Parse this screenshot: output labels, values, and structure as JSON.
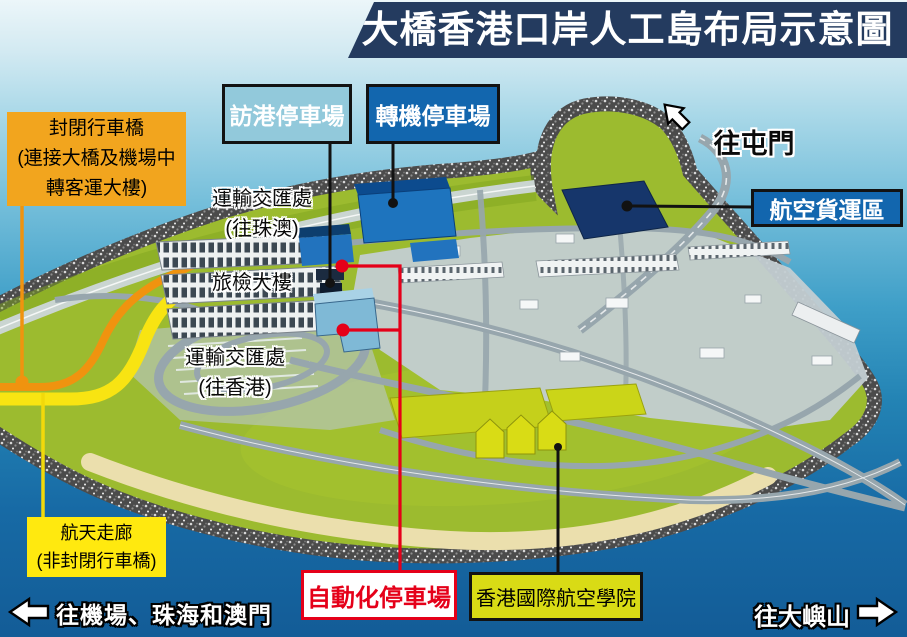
{
  "title": "大橋香港口岸人工島布局示意圖",
  "callouts": {
    "visit_carpark": {
      "label": "訪港停車場"
    },
    "transfer_carpark": {
      "label": "轉機停車場"
    },
    "air_cargo_zone": {
      "label": "航空貨運區"
    },
    "closed_bridge": {
      "lines": [
        "封閉行車橋",
        "(連接大橋及機場中",
        "轉客運大樓)"
      ]
    },
    "sky_corridor": {
      "lines": [
        "航天走廊",
        "(非封閉行車橋)"
      ]
    },
    "automated_carpark": {
      "label": "自動化停車場"
    },
    "aviation_academy": {
      "label": "香港國際航空學院"
    }
  },
  "map_labels": {
    "interchange_zhuhai_macau": {
      "lines": [
        "運輸交匯處",
        "(往珠澳)"
      ]
    },
    "passenger_clearance_building": {
      "label": "旅檢大樓"
    },
    "interchange_hong_kong": {
      "lines": [
        "運輸交匯處",
        "(往香港)"
      ]
    }
  },
  "directions": {
    "tuen_mun": {
      "label": "往屯門"
    },
    "airport_zhuhai_macau": {
      "label": "往機場、珠海和澳門"
    },
    "lantau": {
      "label": "往大嶼山"
    }
  },
  "colors": {
    "title_bg": "#243B5F",
    "callout_blue": "#1266AE",
    "callout_light_blue": "#92C9DB",
    "callout_orange": "#F2A51E",
    "callout_yellow": "#FFE90F",
    "callout_academy_yellow": "#D9DB15",
    "red_accent": "#E50019",
    "island_green": "#9CBB2F",
    "sea_deep": "#135C97"
  }
}
